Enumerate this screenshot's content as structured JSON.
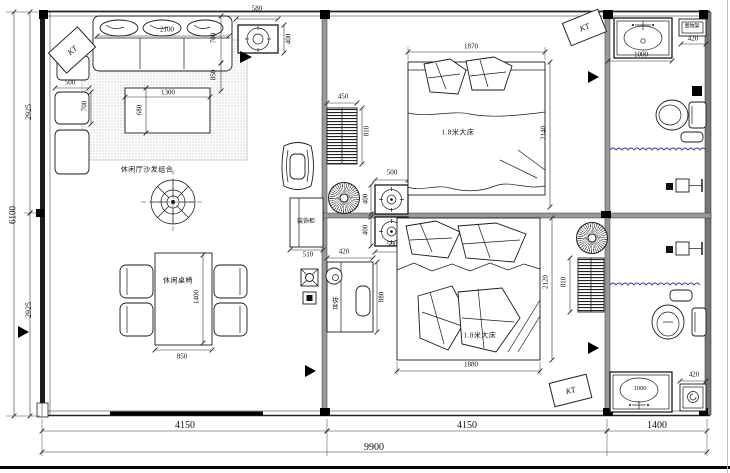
{
  "labels": {
    "kt": "KT",
    "sofa_group": "休闲厅沙发组合",
    "dining_set": "休闲桌椅",
    "bed1": "1.8米大床",
    "bed2": "1.8米大床",
    "deco_cabinet": "装饰柜",
    "makeup_table": "妆台",
    "rack": "置物架"
  },
  "dims": {
    "fixture_w": "580",
    "fixture_h": "400",
    "sofa_w": "2100",
    "sofa_d": "700",
    "sofa_side": "850",
    "side_chair_w": "500",
    "side_chair_d": "700",
    "coffee_w": "1300",
    "coffee_d": "680",
    "left_total": "6100",
    "left_upper": "2925",
    "left_lower": "2925",
    "ladder1_w": "450",
    "ladder1_h": "810",
    "bed1_w": "1870",
    "bed1_l": "2140",
    "vent_top_w": "500",
    "vent_top_h": "400",
    "vent_bottom_w": "500",
    "vent_bottom_h": "400",
    "cabinet_w": "510",
    "makeup_w": "420",
    "makeup_d": "880",
    "dining_l": "1400",
    "dining_w": "850",
    "bed2_w": "1880",
    "bed2_l": "2120",
    "ladder2_h": "810",
    "vanity1_w": "1000",
    "rack1_w": "420",
    "vanity2_w": "1000",
    "rack2_w": "420",
    "bottom_left": "4150",
    "bottom_mid": "4150",
    "bottom_right": "1400",
    "bottom_total": "9900"
  },
  "colors": {
    "shower_curtain": "#3b4a9b"
  }
}
